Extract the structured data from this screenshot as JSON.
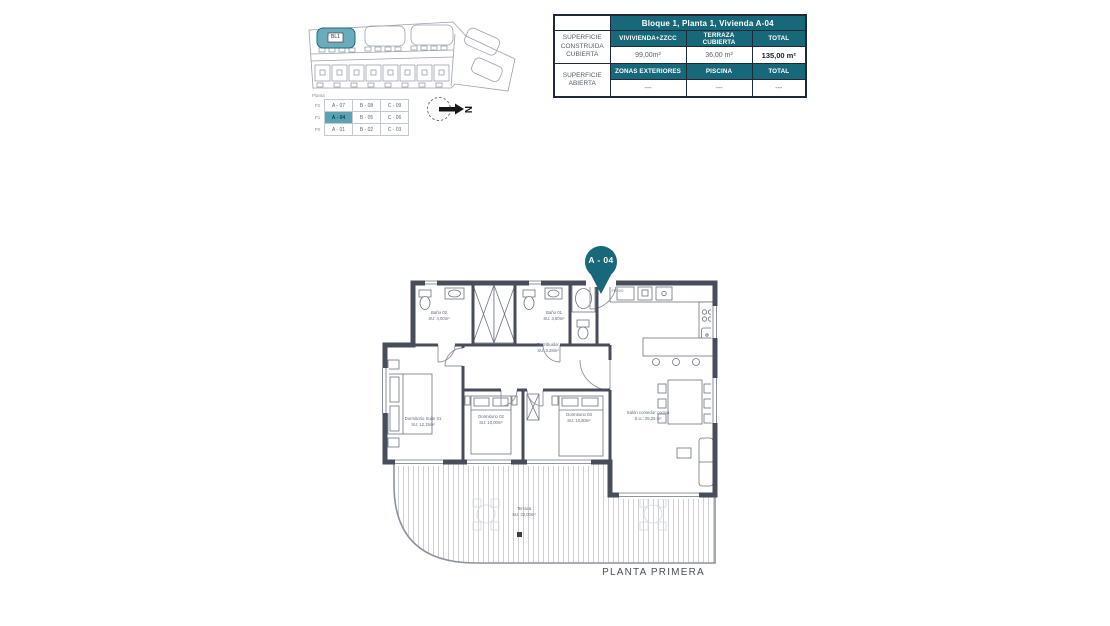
{
  "colors": {
    "accent_teal": "#176878",
    "highlight_teal": "#5ba3b2",
    "building_fill": "#6aacbb",
    "wall": "#474e59",
    "table_border": "#1e2a38"
  },
  "site_plan": {
    "building_label": "BL1",
    "compass_label": "N"
  },
  "unit_table": {
    "corner_label": "Planta",
    "rows": [
      {
        "level": "P2",
        "a": "A - 07",
        "b": "B - 08",
        "c": "C - 09"
      },
      {
        "level": "P1",
        "a": "A - 04",
        "b": "B - 05",
        "c": "C - 06"
      },
      {
        "level": "P0",
        "a": "A - 01",
        "b": "B - 02",
        "c": "C - 03"
      }
    ]
  },
  "surface_table": {
    "title": "Bloque 1, Planta 1, Vivienda A-04",
    "covered_label": "SUPERFICIE CONSTRUIDA CUBIERTA",
    "open_label": "SUPERFICIE ABIERTA",
    "covered_headers": [
      "VIVIVIENDA+ZZCC",
      "TERRAZA CUBIERTA",
      "TOTAL"
    ],
    "covered_values": [
      "99,00m²",
      "36,00 m²",
      "135,00 m²"
    ],
    "open_headers": [
      "ZONAS EXTERIORES",
      "PISCINA",
      "TOTAL"
    ],
    "open_values": [
      "---",
      "---",
      "---"
    ]
  },
  "floor_plan": {
    "pin_label": "A - 04",
    "caption": "PLANTA PRIMERA",
    "kitchen_fridge_label": "FRIGO",
    "rooms": {
      "bano2": {
        "name": "Baño 02",
        "area": "SU: 4,00m²"
      },
      "bano1": {
        "name": "Baño 01",
        "area": "SU: 3,60m²"
      },
      "distribuidor": {
        "name": "Distribuidor",
        "area": "SU: 3,28m²"
      },
      "dorm1": {
        "name": "Dormitorio Suite 01",
        "area": "SU: 12,15m²"
      },
      "dorm2": {
        "name": "Dormitorio 02",
        "area": "SU: 10,00m²"
      },
      "dorm3": {
        "name": "Dormitorio 03",
        "area": "SU: 10,80m²"
      },
      "salon": {
        "name": "Salón comedor cocina",
        "area": "S.U.: 25,25 m²"
      },
      "terraza": {
        "name": "Terraza",
        "area": "SU: 32,00m²"
      }
    }
  }
}
